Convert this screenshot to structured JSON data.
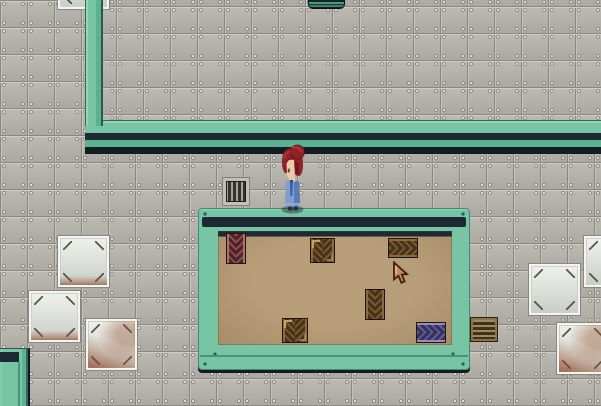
{
  "meta": {
    "scene": "top-down pixel RPG - metal facility with teal walls and a storage room",
    "visible_text": "none"
  },
  "palette": {
    "floor_gray": "#b2afa9",
    "seam_gray": "#8a8780",
    "wall_teal_light": "#93d6b5",
    "wall_teal": "#77c5a5",
    "wall_teal_mid": "#5cb191",
    "wall_teal_dark": "#33685a",
    "wall_navy_band": "#1d2a33",
    "wall_shadow": "#141c22",
    "room_floor_tan": "#b29872",
    "crate_brown_dark": "#46311a",
    "crate_brown_light": "#7a5830",
    "crate_maroon": "#4e2228",
    "crate_purple": "#36315c",
    "white_tile": "#e8ebe6",
    "rust": "#a05a32",
    "hair_red": "#8e2428",
    "dress_blue": "#7e9dd0",
    "cursor_copper": "#cd8a55"
  },
  "entities": [
    {
      "name": "upper-room-floor",
      "type": "tilebg tile-offset",
      "x": 103,
      "y": 0,
      "w": 498,
      "h": 121,
      "z": 0,
      "interactable": false
    },
    {
      "name": "upper-wall-horizontal",
      "type": "wall-h",
      "x": 85,
      "y": 120,
      "w": 516,
      "h": 34,
      "z": 1,
      "interactable": false
    },
    {
      "name": "upper-wall-vertical",
      "type": "wall-v",
      "x": 85,
      "y": 0,
      "w": 18,
      "h": 126,
      "z": 2,
      "interactable": false
    },
    {
      "name": "white-tile-top-partial",
      "type": "white-tile",
      "x": 57,
      "y": -43,
      "w": 53,
      "h": 53,
      "z": 1,
      "interactable": false
    },
    {
      "name": "white-tile-left-top",
      "type": "white-tile rust-edge",
      "x": 57,
      "y": 235,
      "w": 53,
      "h": 53,
      "z": 1,
      "interactable": false
    },
    {
      "name": "white-tile-left-mid",
      "type": "white-tile rust-edge",
      "x": 28,
      "y": 290,
      "w": 53,
      "h": 53,
      "z": 1,
      "interactable": false
    },
    {
      "name": "white-tile-left-bottom",
      "type": "white-tile rusty",
      "x": 85,
      "y": 318,
      "w": 53,
      "h": 53,
      "z": 1,
      "interactable": false
    },
    {
      "name": "white-tile-right-top",
      "type": "white-tile",
      "x": 583,
      "y": 235,
      "w": 53,
      "h": 53,
      "z": 1,
      "interactable": false
    },
    {
      "name": "white-tile-right-mid",
      "type": "white-tile",
      "x": 528,
      "y": 263,
      "w": 53,
      "h": 53,
      "z": 1,
      "interactable": false
    },
    {
      "name": "white-tile-right-bottom",
      "type": "white-tile rusty",
      "x": 556,
      "y": 322,
      "w": 53,
      "h": 53,
      "z": 1,
      "interactable": false
    },
    {
      "name": "console-top-edge",
      "type": "console-top",
      "x": 308,
      "y": 0,
      "w": 37,
      "h": 9,
      "z": 2,
      "interactable": true
    },
    {
      "name": "wall-vent-grate",
      "type": "vent-v",
      "x": 223,
      "y": 178,
      "w": 26,
      "h": 27,
      "z": 2,
      "interactable": true
    },
    {
      "name": "floor-vent-grate",
      "type": "vent-h",
      "x": 471,
      "y": 318,
      "w": 26,
      "h": 23,
      "z": 2,
      "interactable": true
    },
    {
      "name": "teal-wall-corner-bottom-left",
      "type": "teal-block",
      "x": 0,
      "y": 348,
      "w": 30,
      "h": 58,
      "z": 1,
      "interactable": false
    },
    {
      "name": "storage-room-wall",
      "type": "room-wall",
      "x": 198,
      "y": 208,
      "w": 272,
      "h": 162,
      "z": 1,
      "interactable": false
    },
    {
      "name": "storage-room-top-band",
      "type": "navy-band",
      "x": 202,
      "y": 217,
      "w": 264,
      "h": 10,
      "z": 2,
      "interactable": false
    },
    {
      "name": "storage-room-floor",
      "type": "room-floor",
      "x": 218,
      "y": 231,
      "w": 234,
      "h": 114,
      "z": 2,
      "interactable": false
    },
    {
      "name": "storage-room-wall-groove",
      "type": "teal-line",
      "x": 200,
      "y": 355,
      "w": 268,
      "h": 2,
      "z": 3,
      "interactable": false
    },
    {
      "name": "crate-tall-maroon",
      "type": "crate chev-v maroon",
      "x": 226,
      "y": 233,
      "w": 20,
      "h": 31,
      "z": 3,
      "interactable": true
    },
    {
      "name": "crate-square-top",
      "type": "crate chev-v brown marks",
      "x": 310,
      "y": 238,
      "w": 25,
      "h": 25,
      "z": 3,
      "interactable": true
    },
    {
      "name": "crate-horizontal-top",
      "type": "crate chev-h brown",
      "x": 388,
      "y": 238,
      "w": 30,
      "h": 20,
      "z": 3,
      "interactable": true
    },
    {
      "name": "crate-vertical-middle",
      "type": "crate chev-v brown",
      "x": 365,
      "y": 289,
      "w": 20,
      "h": 31,
      "z": 3,
      "interactable": true
    },
    {
      "name": "crate-square-bottom",
      "type": "crate chev-v brown marks",
      "x": 282,
      "y": 318,
      "w": 26,
      "h": 25,
      "z": 3,
      "interactable": true
    },
    {
      "name": "crate-purple",
      "type": "crate chev-h purple",
      "x": 416,
      "y": 322,
      "w": 30,
      "h": 21,
      "z": 3,
      "interactable": true
    },
    {
      "name": "player-character",
      "type": "character",
      "x": 277,
      "y": 143,
      "w": 30,
      "h": 71,
      "z": 5,
      "interactable": true
    },
    {
      "name": "mouse-cursor",
      "type": "cursor",
      "x": 392,
      "y": 261,
      "w": 19,
      "h": 25,
      "z": 9,
      "interactable": false
    }
  ]
}
